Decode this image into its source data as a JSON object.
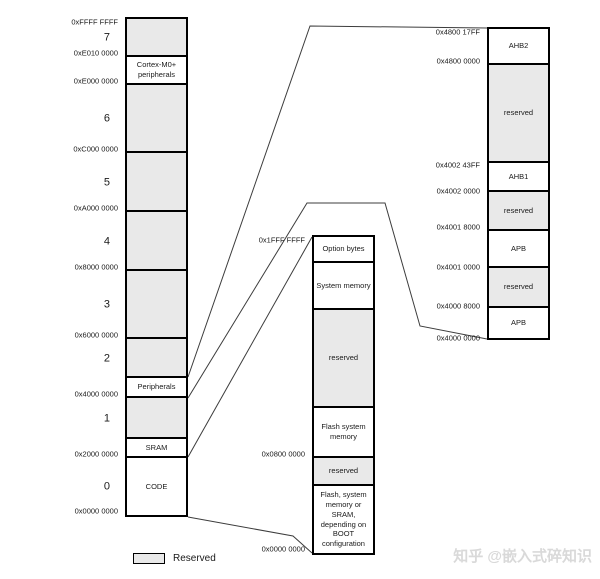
{
  "diagram": {
    "legend": {
      "label": "Reserved"
    },
    "watermark": "知乎 @嵌入式碎知识",
    "colors": {
      "reserved_fill": "#e9e9e9",
      "box_fill": "#ffffff",
      "border": "#000000",
      "connector": "#3c3c3c",
      "watermark": "#d9d9d9"
    },
    "columns": [
      {
        "id": "main-memory-map",
        "x": 125,
        "y": 17,
        "w": 63,
        "h": 500,
        "top_address": "0xFFFF FFFF",
        "segments": [
          {
            "num": "7",
            "reserved": true,
            "h": 38,
            "address": "0xE010 0000"
          },
          {
            "label": "Cortex-M0+ peripherals",
            "h": 28,
            "address": "0xE000 0000"
          },
          {
            "num": "6",
            "reserved": true,
            "h": 68,
            "address": "0xC000 0000"
          },
          {
            "num": "5",
            "reserved": true,
            "h": 59,
            "address": "0xA000 0000"
          },
          {
            "num": "4",
            "reserved": true,
            "h": 59,
            "address": "0x8000 0000"
          },
          {
            "num": "3",
            "reserved": true,
            "h": 68,
            "address": "0x6000 0000"
          },
          {
            "num": "2",
            "reserved": true,
            "h": 39
          },
          {
            "label": "Peripherals",
            "h": 20,
            "address": "0x4000 0000"
          },
          {
            "num": "1",
            "reserved": true,
            "h": 41
          },
          {
            "label": "SRAM",
            "h": 19,
            "address": "0x2000 0000"
          },
          {
            "num": "0",
            "label": "CODE",
            "h": 57,
            "address": "0x0000 0000"
          }
        ]
      },
      {
        "id": "code-detail",
        "x": 312,
        "y": 235,
        "w": 63,
        "h": 320,
        "top_address": "0x1FFF FFFF",
        "segments": [
          {
            "label": "Option bytes",
            "h": 26
          },
          {
            "label": "System memory",
            "h": 47
          },
          {
            "label": "reserved",
            "reserved": true,
            "h": 98
          },
          {
            "label": "Flash system memory",
            "h": 50,
            "address": "0x0800 0000"
          },
          {
            "label": "reserved",
            "reserved": true,
            "h": 28
          },
          {
            "label": "Flash, system memory or SRAM, depending on BOOT configuration",
            "h": 67,
            "address": "0x0000 0000"
          }
        ]
      },
      {
        "id": "peripheral-detail",
        "x": 487,
        "y": 27,
        "w": 63,
        "h": 313,
        "top_address": "0x4800 17FF",
        "segments": [
          {
            "label": "AHB2",
            "h": 36,
            "address": "0x4800 0000"
          },
          {
            "label": "reserved",
            "reserved": true,
            "h": 98,
            "address": "0x4002 43FF",
            "addr_dy": 6
          },
          {
            "label": "AHB1",
            "h": 29,
            "address": "0x4002 0000",
            "addr_dy": 3
          },
          {
            "label": "reserved",
            "reserved": true,
            "h": 39,
            "address": "0x4001 8000"
          },
          {
            "label": "APB",
            "h": 37,
            "address": "0x4001 0000",
            "addr_dy": 3
          },
          {
            "label": "reserved",
            "reserved": true,
            "h": 40,
            "address": "0x4000 8000",
            "addr_dy": 2
          },
          {
            "label": "APB",
            "h": 30,
            "address": "0x4000 0000",
            "addr_dy": 4
          }
        ]
      }
    ],
    "connectors": [
      {
        "name": "peripherals-to-detail-top-line",
        "points": "188,377 310,26 487,28"
      },
      {
        "name": "peripherals-to-detail-bottom-line",
        "points": "188,398 307,203 385,203 420,326 487,339"
      },
      {
        "name": "code-to-detail-top-line",
        "points": "188,457 312,237"
      },
      {
        "name": "code-to-detail-bottom-line",
        "points": "188,517 293,536 312,553"
      }
    ]
  }
}
